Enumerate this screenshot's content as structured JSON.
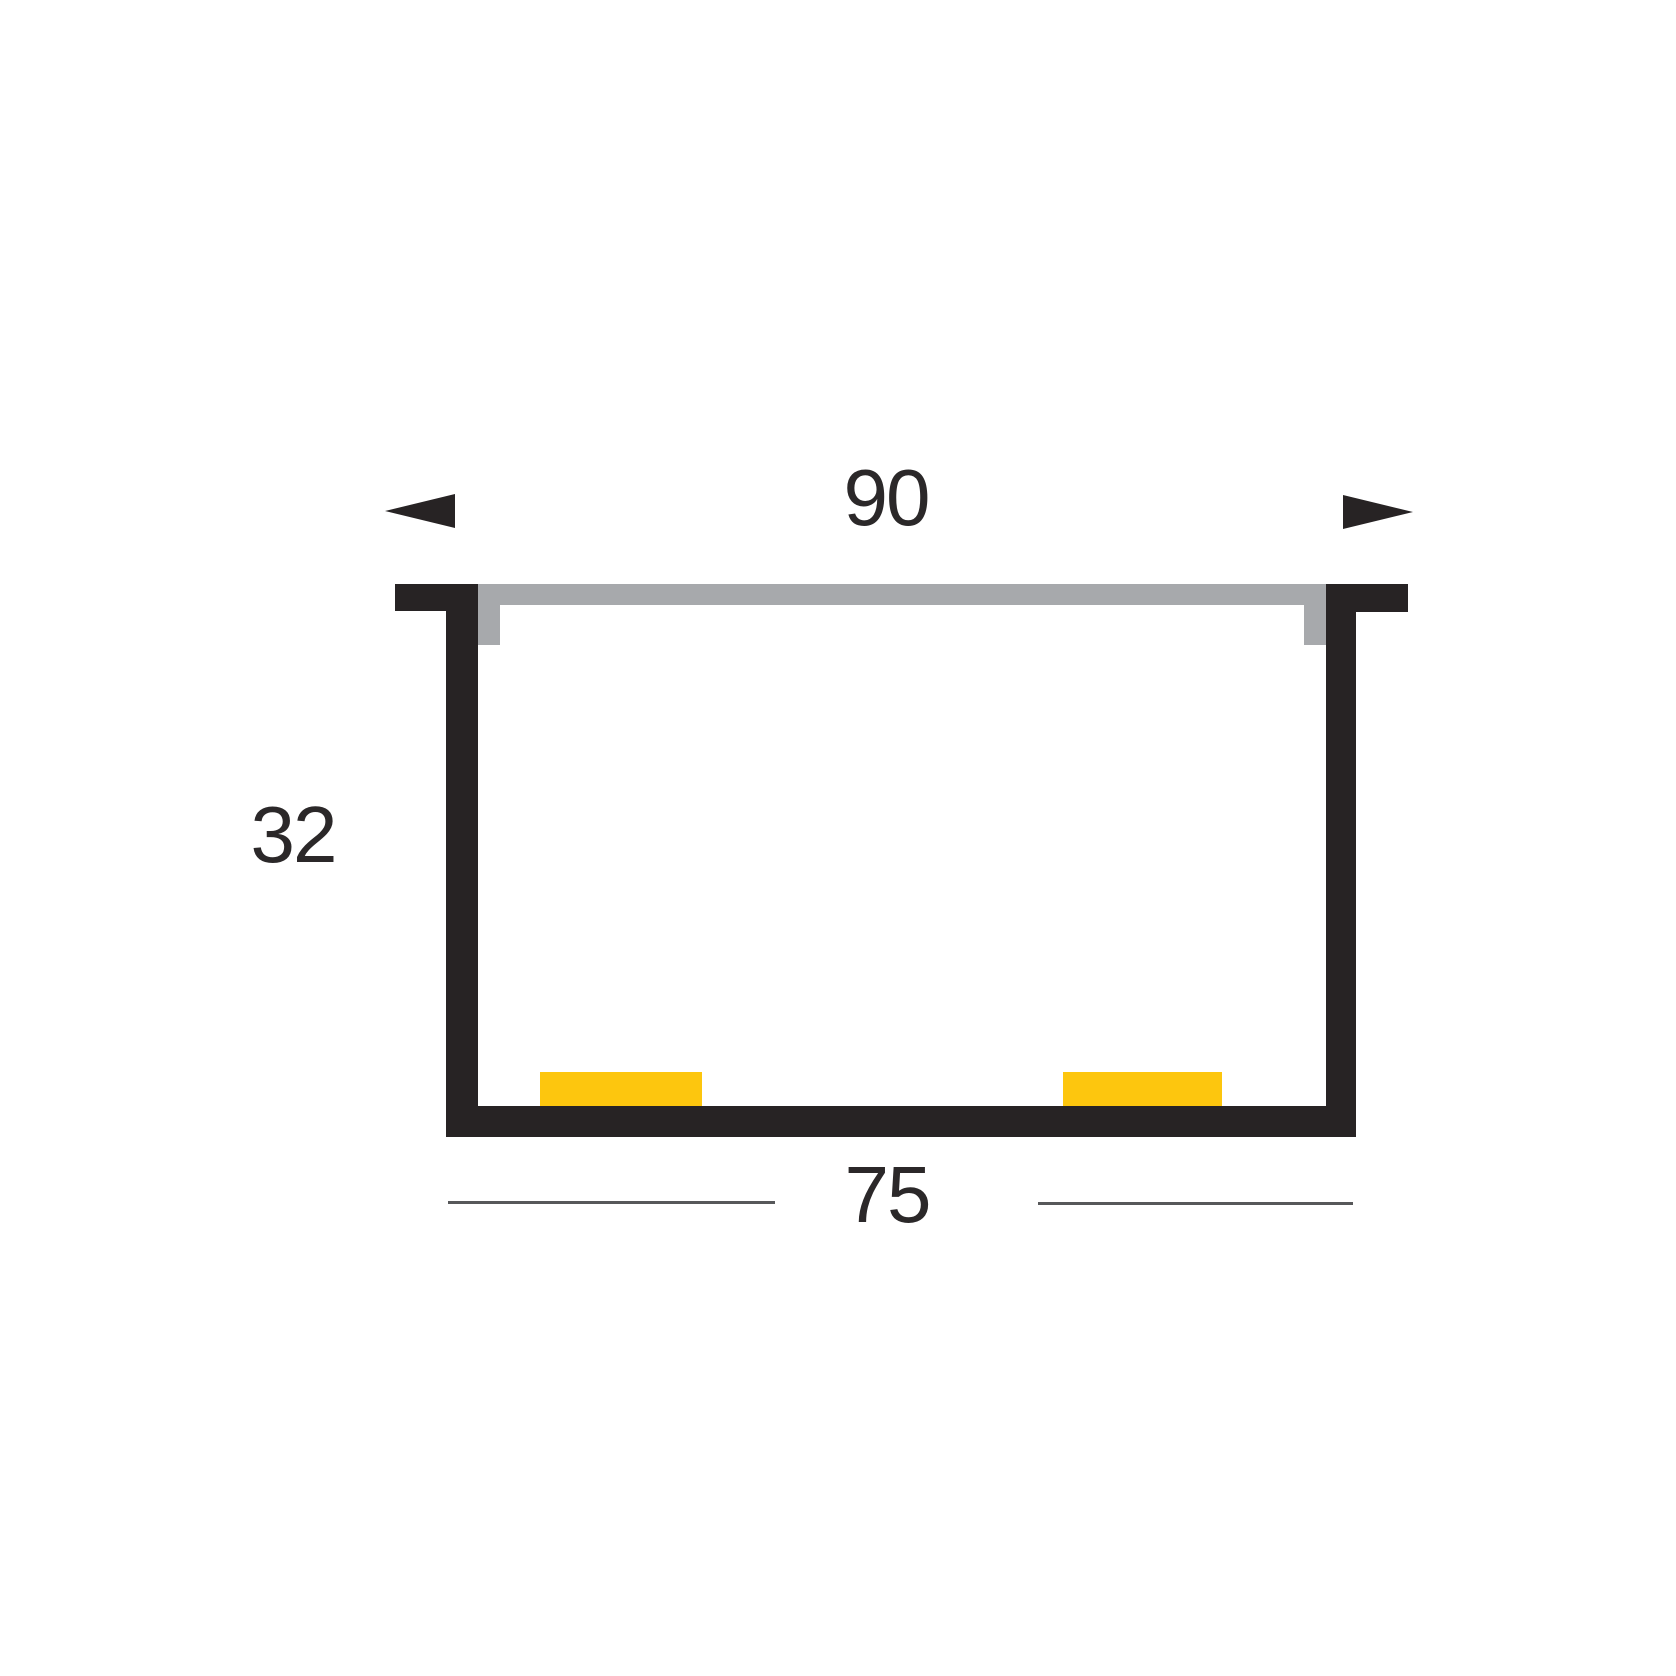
{
  "diagram": {
    "type": "profile-cross-section",
    "dimensions": {
      "outer_width": "90",
      "height": "32",
      "inner_width": "75"
    }
  },
  "icons": {
    "left_arrowhead": "triangle-pointing-left",
    "right_arrowhead": "triangle-pointing-right"
  },
  "colors": {
    "bg": "#ffffff",
    "profile-black": "#272324",
    "cover-gray": "#a7a9ac",
    "led-yellow": "#fdc60e",
    "dim-line": "#57585a",
    "dim-text": "#2b2829"
  }
}
